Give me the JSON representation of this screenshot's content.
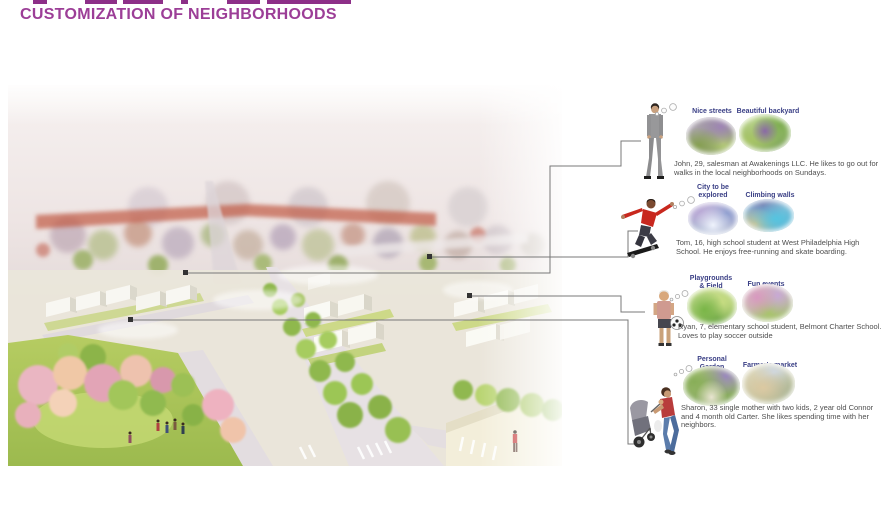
{
  "slide": {
    "title": "CUSTOMIZATION OF NEIGHBORHOODS"
  },
  "colors": {
    "title": "#9c3e97",
    "thumb_label": "#3a3f85",
    "description_text": "#4f4f4f",
    "connector_line": "#787878",
    "top_edge_fragments": "#8d2f88"
  },
  "main_image": {
    "description": "Hazy watercolor aerial rendering of a neighborhood: distant rowhouses fading to white, white box buildings, tree-lined avenue, pink blossom park with people, street intersection with crosswalks and a pedestrian in red"
  },
  "personas": [
    {
      "id": "john",
      "figure": "man-in-suit-walking",
      "thumbs": [
        {
          "label": "Nice streets"
        },
        {
          "label": "Beautiful backyard"
        }
      ],
      "description": "John, 29, salesman at Awakenings LLC. He likes to go out for walks in the local neighborhoods on Sundays."
    },
    {
      "id": "tom",
      "figure": "teen-skateboarder",
      "thumbs": [
        {
          "label": "City to be\nexplored"
        },
        {
          "label": "Climbing walls"
        }
      ],
      "description": "Tom, 16, high school student at West Philadelphia High School. He enjoys free-running and skate boarding."
    },
    {
      "id": "ryan",
      "figure": "boy-with-soccer-ball",
      "thumbs": [
        {
          "label": "Playgrounds\n& Field"
        },
        {
          "label": "Fun events"
        }
      ],
      "description": "Ryan, 7, elementary school student, Belmont Charter School. Loves to play soccer outside"
    },
    {
      "id": "sharon",
      "figure": "mother-with-stroller",
      "thumbs": [
        {
          "label": "Personal\nGarden"
        },
        {
          "label": "Farmer's market"
        }
      ],
      "description": "Sharon, 33 single mother with two kids, 2 year old Connor and 4 month old Carter. She likes spending time with her neighbors."
    }
  ]
}
